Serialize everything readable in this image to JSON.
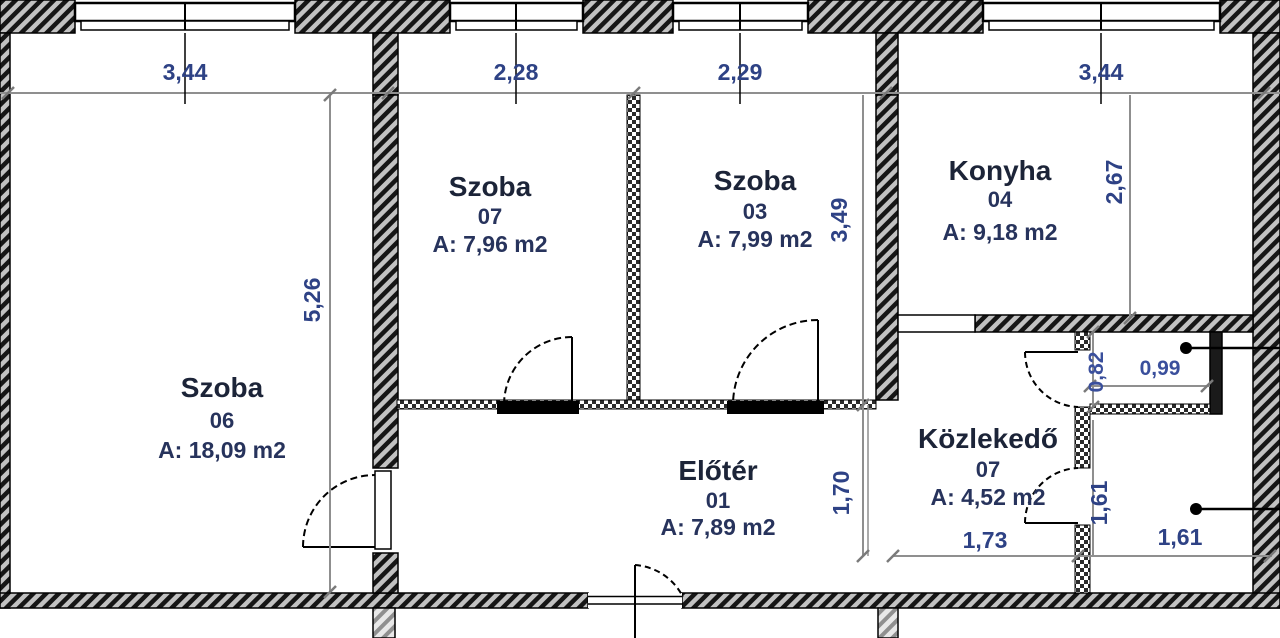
{
  "plan": {
    "title": "Apartment floor plan",
    "rooms": {
      "szoba06": {
        "name": "Szoba",
        "number": "06",
        "area": "A: 18,09 m2"
      },
      "szoba07": {
        "name": "Szoba",
        "number": "07",
        "area": "A: 7,96 m2"
      },
      "szoba03": {
        "name": "Szoba",
        "number": "03",
        "area": "A: 7,99 m2"
      },
      "konyha": {
        "name": "Konyha",
        "number": "04",
        "area": "A: 9,18 m2"
      },
      "eloter": {
        "name": "Előtér",
        "number": "01",
        "area": "A: 7,89 m2"
      },
      "kozlekedo": {
        "name": "Közlekedő",
        "number": "07",
        "area": "A: 4,52 m2"
      }
    },
    "dimensions": {
      "top": [
        "3,44",
        "2,28",
        "2,29",
        "3,44"
      ],
      "left_room_height": "5,26",
      "middle_rooms_height": "3,49",
      "kitchen_height": "2,67",
      "closet_height": "0,82",
      "closet_width": "0,99",
      "hall_height": "1,70",
      "bath_height": "1,61",
      "corridor_width": "1,73",
      "bath_width": "1,61"
    },
    "colors": {
      "dimension_text": "#2e4285",
      "room_text": "#1c2438",
      "wall_stroke": "#000000",
      "dimension_line": "#8f8f8f"
    }
  }
}
